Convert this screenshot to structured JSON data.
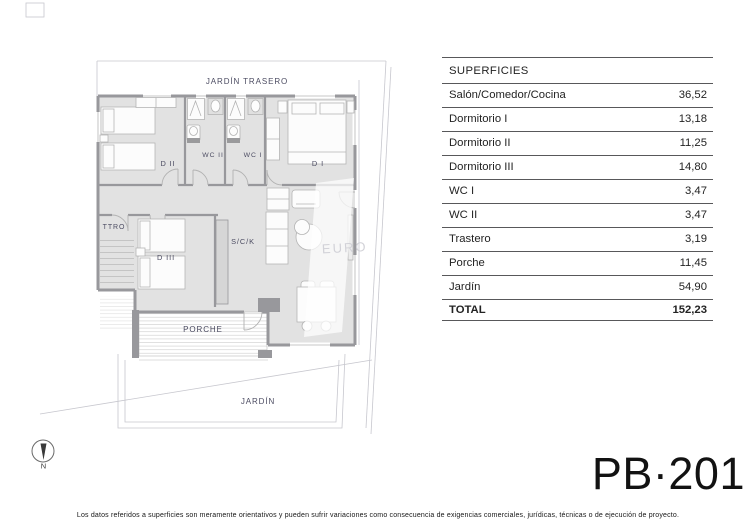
{
  "plan": {
    "area_labels": {
      "jardin_trasero": "JARDÍN TRASERO",
      "porche": "PORCHE",
      "jardin": "JARDÍN",
      "sck": "S/C/K",
      "ttro": "TTRO",
      "d1": "D I",
      "d2": "D II",
      "d3": "D III",
      "wc1": "WC I",
      "wc2": "WC II"
    },
    "compass_north": "N",
    "watermark": "EURO"
  },
  "surfaces_table": {
    "title": "SUPERFICIES",
    "rows": [
      {
        "label": "Salón/Comedor/Cocina",
        "value": "36,52"
      },
      {
        "label": "Dormitorio I",
        "value": "13,18"
      },
      {
        "label": "Dormitorio II",
        "value": "11,25"
      },
      {
        "label": "Dormitorio III",
        "value": "14,80"
      },
      {
        "label": "WC I",
        "value": "3,47"
      },
      {
        "label": "WC II",
        "value": "3,47"
      },
      {
        "label": "Trastero",
        "value": "3,19"
      },
      {
        "label": "Porche",
        "value": "11,45"
      },
      {
        "label": "Jardín",
        "value": "54,90"
      }
    ],
    "total": {
      "label": "TOTAL",
      "value": "152,23"
    }
  },
  "plan_code": "PB·201",
  "disclaimer": "Los datos referidos a superficies son meramente orientativos y pueden sufrir variaciones como consecuencia de exigencias comerciales, jurídicas, técnicas o de ejecución de proyecto.",
  "colors": {
    "floor": "#e2e2e2",
    "wall": "#98989c",
    "boundary": "#c7c7ce",
    "table_line": "#58585a",
    "label_text": "#4c4c62"
  }
}
